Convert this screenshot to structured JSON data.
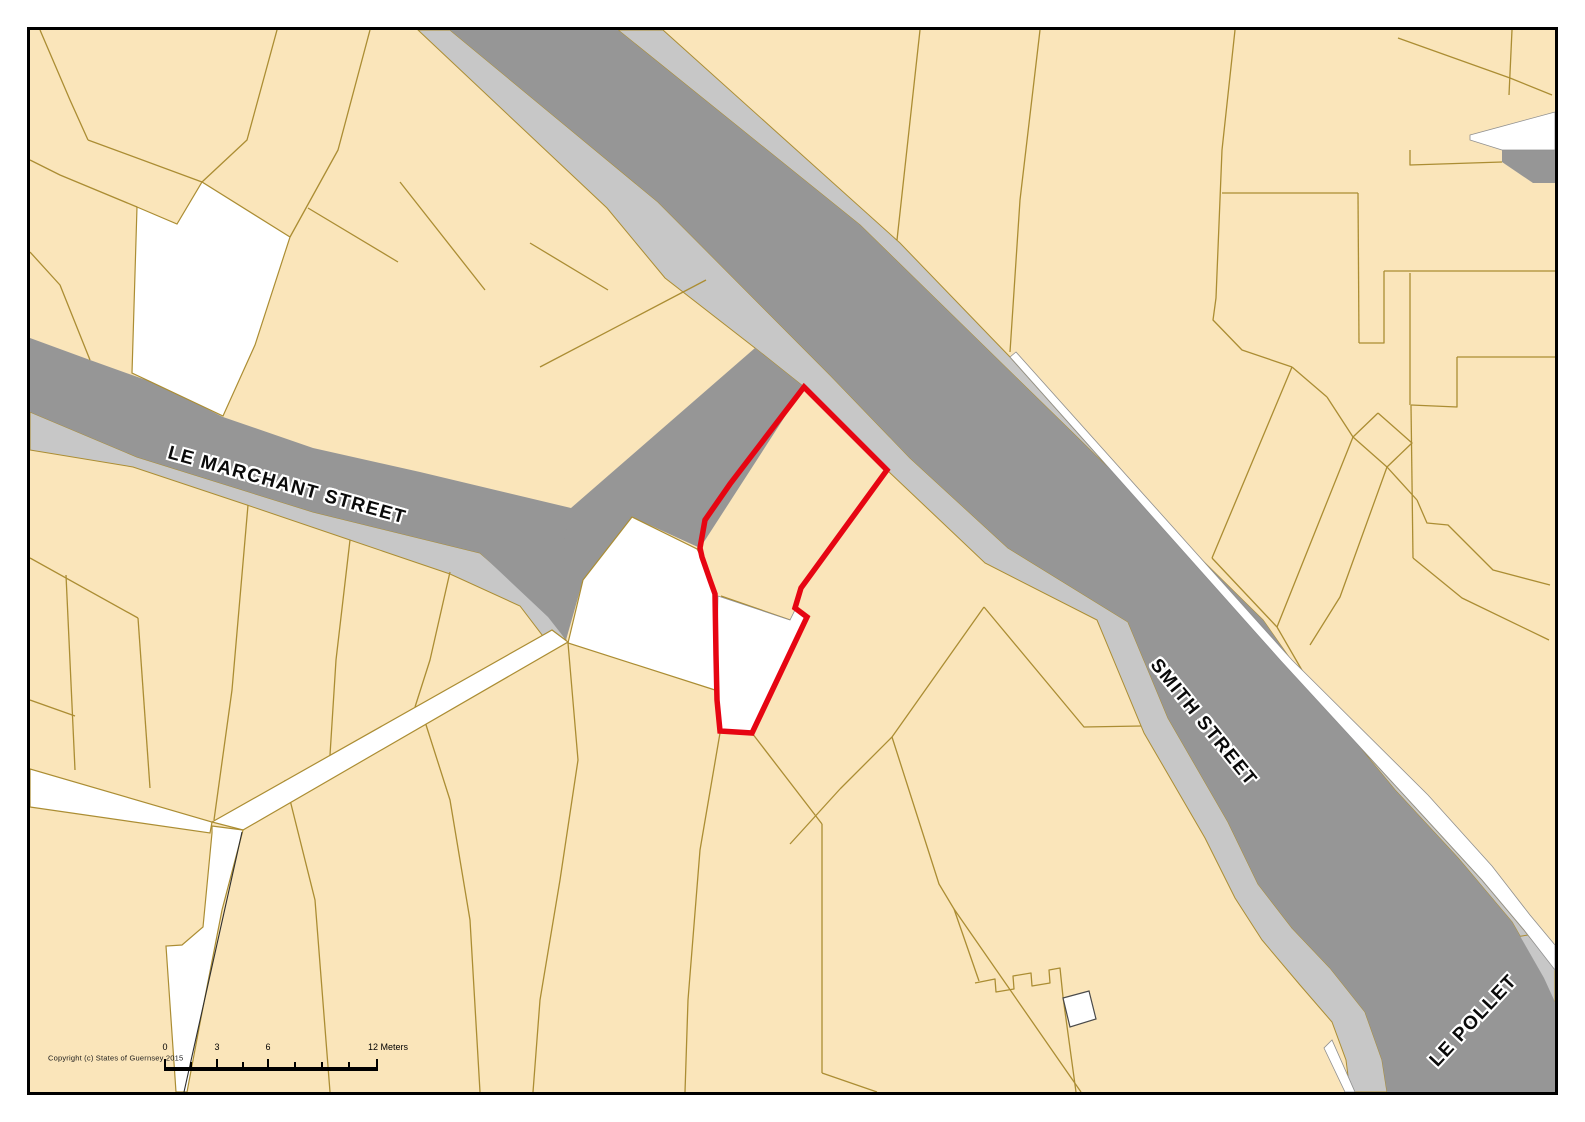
{
  "map": {
    "title": "Guernsey parcel map extract",
    "colors": {
      "cream": "#fae5ba",
      "olive": "#ab8d33",
      "dark": "#969696",
      "light": "#c7c7c7",
      "red": "#e60512",
      "frame": "#000000",
      "white": "#ffffff"
    },
    "street_labels": {
      "le_marchant": {
        "text": "LE MARCHANT STREET",
        "x": 287,
        "y": 486,
        "rot": 15.5,
        "anchor": "center"
      },
      "smith": {
        "text": "SMITH STREET",
        "x": 1203,
        "y": 723,
        "rot": 51,
        "anchor": "center"
      },
      "le_pollet": {
        "text": "LE POLLET",
        "x": 1474,
        "y": 1021,
        "rot": -47,
        "anchor": "center"
      }
    },
    "copyright": {
      "text": "Copyright (c) States of Guernsey 2015",
      "x": 48,
      "y": 1058,
      "anchor": "left"
    },
    "scale_bar": {
      "bar": {
        "x1": 165,
        "x2": 377,
        "y": 1067,
        "h": 4
      },
      "major_ticks": [
        165,
        217,
        268,
        377
      ],
      "minor_ticks": [
        191,
        243,
        295,
        322,
        349
      ],
      "major_tick_h": 8,
      "minor_tick_h": 5,
      "labels": [
        {
          "text": "0",
          "x": 165,
          "y": 1047,
          "anchor": "center"
        },
        {
          "text": "3",
          "x": 217,
          "y": 1047,
          "anchor": "center"
        },
        {
          "text": "6",
          "x": 268,
          "y": 1047,
          "anchor": "center"
        },
        {
          "text": "12 Meters",
          "x": 368,
          "y": 1047,
          "anchor": "left"
        }
      ]
    },
    "geometry": {
      "map_rect": {
        "x": 30,
        "y": 30,
        "w": 1525,
        "h": 1062
      },
      "light_polys": [
        {
          "n": "smith-street-sw-sidewalk",
          "p": "418,30 607,208 665,278 755,348 804,387 887,470 985,563 1097,620 1144,733 1205,838 1235,898 1262,940 1300,985 1332,1022 1346,1060 1350,1092 1387,1092 1382,1060 1365,1012 1330,968 1292,928 1258,884 1228,822 1168,718 1128,622 1008,548 910,458 830,375 658,202 450,30"
        },
        {
          "n": "smith-street-ne-sidewalk",
          "p": "618,30 860,225 1080,440 1263,620 1310,687 1395,790 1458,858 1512,922 1544,978 1555,1002 1555,970 1524,930 1482,880 1416,808 1280,660 1010,357 900,243 663,30"
        },
        {
          "n": "le-marchant-s-sidewalk",
          "p": "30,412 137,457 313,512 480,553 548,612 566,640 552,648 520,606 450,574 350,540 247,505 133,467 30,450"
        },
        {
          "n": "le-pollet-se-sidewalk",
          "p": "1555,968 1555,1008 1534,972 1510,938 1528,935"
        }
      ],
      "dark_polys": [
        {
          "n": "smith-street-le-pollet-roadway",
          "p": "450,30 618,30 860,225 1080,440 1263,620 1310,687 1395,790 1458,858 1512,922 1544,978 1555,1002 1555,1092 1387,1092 1382,1060 1365,1012 1330,968 1292,928 1258,884 1228,822 1168,718 1128,622 1008,548 910,458 830,375 658,202"
        },
        {
          "n": "street-junction-area",
          "p": "755,348 804,387 700,548 632,517 583,580 566,640 548,617 543,540 571,508"
        },
        {
          "n": "le-marchant-roadway",
          "p": "30,338 90,360 160,385 223,417 313,448 420,472 571,508 548,617 480,553 313,512 137,457 30,412"
        },
        {
          "n": "gray-patch-top-right",
          "p": "1502,150 1555,150 1555,183 1533,183 1502,162"
        }
      ],
      "parcel_lines": [
        {
          "n": "parcel-line",
          "p": "40,30 70,100 88,140"
        },
        {
          "n": "parcel-line",
          "p": "88,140 202,182"
        },
        {
          "n": "parcel-line",
          "p": "30,160 60,175 137,207"
        },
        {
          "n": "parcel-line",
          "p": "202,182 247,140 277,30"
        },
        {
          "n": "parcel-line",
          "p": "290,237 338,150 370,30"
        },
        {
          "n": "parcel-line",
          "p": "308,208 398,262"
        },
        {
          "n": "parcel-line",
          "p": "400,182 485,290"
        },
        {
          "n": "parcel-line",
          "p": "530,243 608,290"
        },
        {
          "n": "parcel-line",
          "p": "30,252 60,285 90,360"
        },
        {
          "n": "parcel-line",
          "p": "540,367 706,280"
        },
        {
          "n": "parcel-line",
          "p": "30,558 138,618"
        },
        {
          "n": "parcel-line",
          "p": "138,618 150,788"
        },
        {
          "n": "parcel-line",
          "p": "66,575 75,770"
        },
        {
          "n": "parcel-line",
          "p": "30,700 75,716"
        },
        {
          "n": "parcel-line",
          "p": "248,505 232,690 214,820"
        },
        {
          "n": "parcel-line",
          "p": "350,540 336,660 330,755"
        },
        {
          "n": "parcel-line",
          "p": "450,572 430,660 415,707"
        },
        {
          "n": "parcel-line",
          "p": "285,780 315,900 330,1092"
        },
        {
          "n": "parcel-line",
          "p": "420,706 450,800 470,920 480,1092"
        },
        {
          "n": "parcel-line",
          "p": "568,643 578,760 560,880 540,1000 533,1092"
        },
        {
          "n": "parcel-line",
          "p": "720,733 700,850 688,1000 685,1092"
        },
        {
          "n": "parcel-line",
          "p": "752,733 822,824"
        },
        {
          "n": "parcel-line",
          "p": "822,824 822,1073"
        },
        {
          "n": "parcel-line",
          "p": "790,844 840,789"
        },
        {
          "n": "parcel-line",
          "p": "840,789 892,737 984,607"
        },
        {
          "n": "parcel-line",
          "p": "984,607 1084,727 1141,726"
        },
        {
          "n": "parcel-line",
          "p": "892,737 939,884 954,909 1081,1092"
        },
        {
          "n": "parcel-line",
          "p": "954,909 979,981"
        },
        {
          "n": "parcel-line-battlement",
          "p": "975,983 995,979 996,992 1014,989 1013,976 1031,973 1032,986 1050,983 1049,970 1060,968 1063,997"
        },
        {
          "n": "parcel-line",
          "p": "1063,997 1076,1092"
        },
        {
          "n": "parcel-line",
          "p": "822,1073 877,1092"
        },
        {
          "n": "parcel-line",
          "p": "920,30 897,240"
        },
        {
          "n": "parcel-line",
          "p": "1040,30 1020,200 1010,352"
        },
        {
          "n": "parcel-line",
          "p": "1235,30 1222,150 1216,298 1213,320 1242,350 1292,367"
        },
        {
          "n": "parcel-line",
          "p": "1222,193 1358,193"
        },
        {
          "n": "parcel-line",
          "p": "1358,193 1359,343"
        },
        {
          "n": "parcel-line",
          "p": "1359,343 1384,343 1384,271"
        },
        {
          "n": "parcel-line",
          "p": "1384,271 1555,271"
        },
        {
          "n": "parcel-line",
          "p": "1410,150 1410,165 1502,162"
        },
        {
          "n": "parcel-line",
          "p": "1457,357 1555,357"
        },
        {
          "n": "parcel-line",
          "p": "1457,357 1457,407 1411,405"
        },
        {
          "n": "parcel-line",
          "p": "1410,273 1410,405"
        },
        {
          "n": "parcel-line",
          "p": "1411,405 1413,558"
        },
        {
          "n": "parcel-line",
          "p": "1413,558 1462,598 1549,640"
        },
        {
          "n": "parcel-line",
          "p": "1292,367 1212,558"
        },
        {
          "n": "parcel-line",
          "p": "1212,558 1277,627"
        },
        {
          "n": "parcel-line",
          "p": "1292,367 1327,397"
        },
        {
          "n": "parcel-line",
          "p": "1327,397 1353,437"
        },
        {
          "n": "parcel-line",
          "p": "1378,413 1412,443 1387,467 1353,437 1378,413"
        },
        {
          "n": "parcel-line",
          "p": "1353,437 1277,627"
        },
        {
          "n": "parcel-line",
          "p": "1387,467 1340,597 1310,645"
        },
        {
          "n": "parcel-line",
          "p": "1387,467 1417,500"
        },
        {
          "n": "parcel-line",
          "p": "1417,500 1427,523 1448,525 1493,570 1550,585"
        },
        {
          "n": "parcel-line",
          "p": "1277,627 1303,672"
        },
        {
          "n": "parcel-line",
          "p": "1398,38 1510,78 1552,95"
        },
        {
          "n": "parcel-line",
          "p": "1512,30 1509,95"
        },
        {
          "n": "red-parcel-inner-divider",
          "p": "721,596 790,620"
        }
      ],
      "white_polys": [
        {
          "n": "white-parcel-top-left",
          "c": "white",
          "p": "137,207 177,224 202,182 290,237 255,345 223,416 132,373"
        },
        {
          "n": "white-parcel-center",
          "c": "white",
          "p": "632,517 697,549 703,560 710,580 715,594 716,650 715,690 568,643 583,580"
        },
        {
          "n": "red-parcel-lower-lobe-white",
          "c": "whitesoft",
          "p": "718,596 716,700 720,731 752,733 806,618 795,610 790,620"
        },
        {
          "n": "white-lane-west",
          "c": "white",
          "p": "30,769 212,822 210,833 30,807"
        },
        {
          "n": "white-lane-to-junction",
          "c": "white",
          "p": "212,822 552,630 568,642 243,830"
        },
        {
          "n": "white-lane-south",
          "c": "white",
          "p": "212,826 243,830 222,910 200,1023 187,1092 176,1092 166,946 182,945 203,927 212,833"
        },
        {
          "n": "white-box-small",
          "c": "whitebox",
          "p": "1063,998 1089,991 1096,1019 1070,1027"
        },
        {
          "n": "white-strip-ne-of-road",
          "c": "whitesoft",
          "p": "1016,352 1292,660 1428,795 1492,866 1530,915 1555,945 1555,970 1524,930 1482,880 1416,808 1280,660 1010,357"
        },
        {
          "n": "white-sliver-top-right",
          "c": "whitesoft",
          "p": "1470,135 1555,112 1555,150 1502,150 1470,140"
        },
        {
          "n": "white-sliver-le-pollet",
          "c": "whitesoft",
          "p": "1345,1092 1355,1092 1332,1040 1324,1048"
        }
      ],
      "hairlines": [
        {
          "n": "lane-hairline",
          "p": "242,832 184,1092"
        }
      ],
      "red_parcel_outline": {
        "n": "red-parcel-outline",
        "p": "804,387 887,470 801,588 795,608 807,617 752,733 720,731 717,700 716,655 715,594 710,580 702,557 700,548 705,520 730,484"
      }
    }
  }
}
